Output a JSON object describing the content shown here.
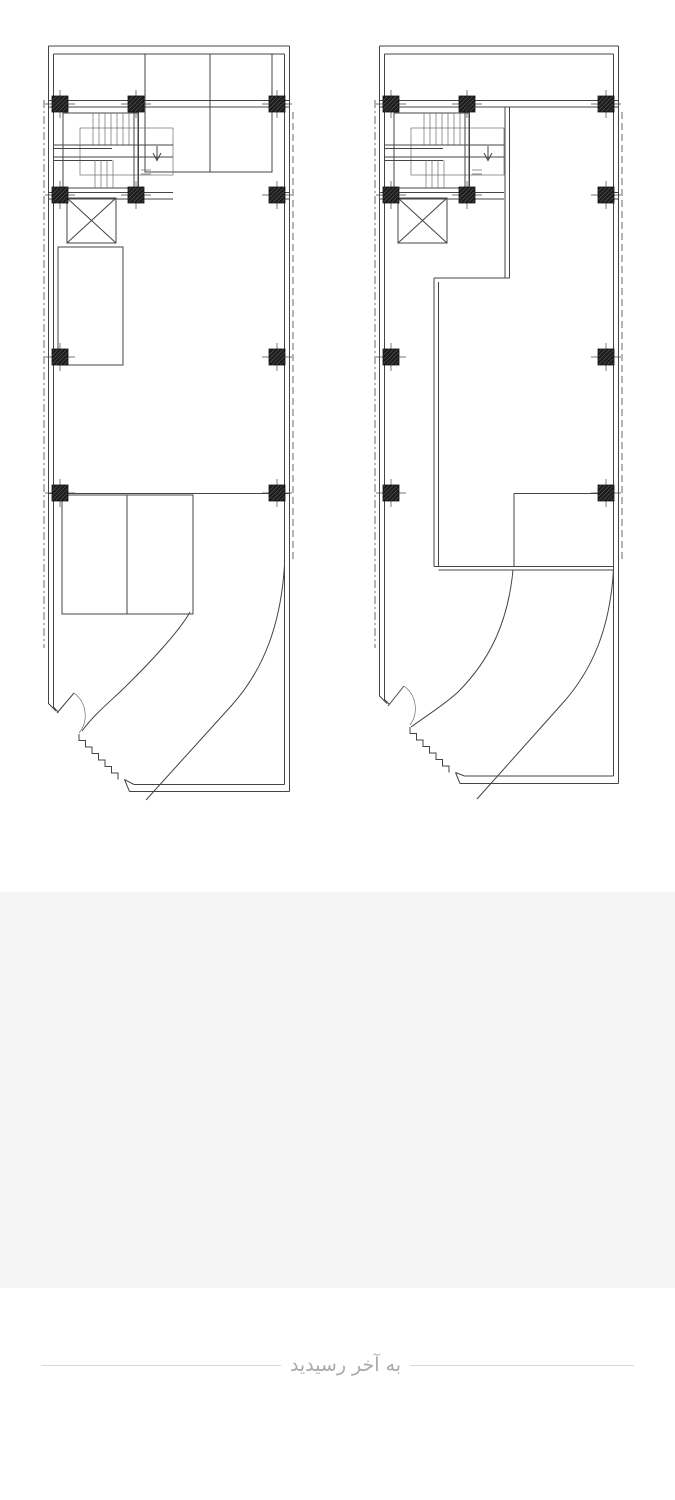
{
  "page": {
    "background_color": "#ffffff"
  },
  "gallery": {
    "images": [
      {
        "label": "architectural floor plan sheet 1"
      },
      {
        "label": "architectural floor plan sheet 2"
      }
    ],
    "placeholder": {
      "color": "#f5f5f5"
    }
  },
  "drawing": {
    "stroke_color": "#444444",
    "column_fill_color": "#1c1c1c",
    "dashed_line_color": "#5a5a5a",
    "column_size": 16,
    "columns_plan1": [
      [
        60,
        104
      ],
      [
        136,
        104
      ],
      [
        277,
        104
      ],
      [
        60,
        195
      ],
      [
        136,
        195
      ],
      [
        277,
        195
      ],
      [
        60,
        357
      ],
      [
        277,
        357
      ],
      [
        60,
        493
      ],
      [
        277,
        493
      ]
    ],
    "columns_plan2": [
      [
        391,
        104
      ],
      [
        467,
        104
      ],
      [
        606,
        104
      ],
      [
        391,
        195
      ],
      [
        467,
        195
      ],
      [
        606,
        195
      ],
      [
        391,
        357
      ],
      [
        606,
        357
      ],
      [
        391,
        493
      ],
      [
        606,
        493
      ]
    ]
  },
  "footer": {
    "end_text": "به آخر رسیدید",
    "text_color": "#a9a9a9",
    "divider_color": "#d9d9d9"
  }
}
